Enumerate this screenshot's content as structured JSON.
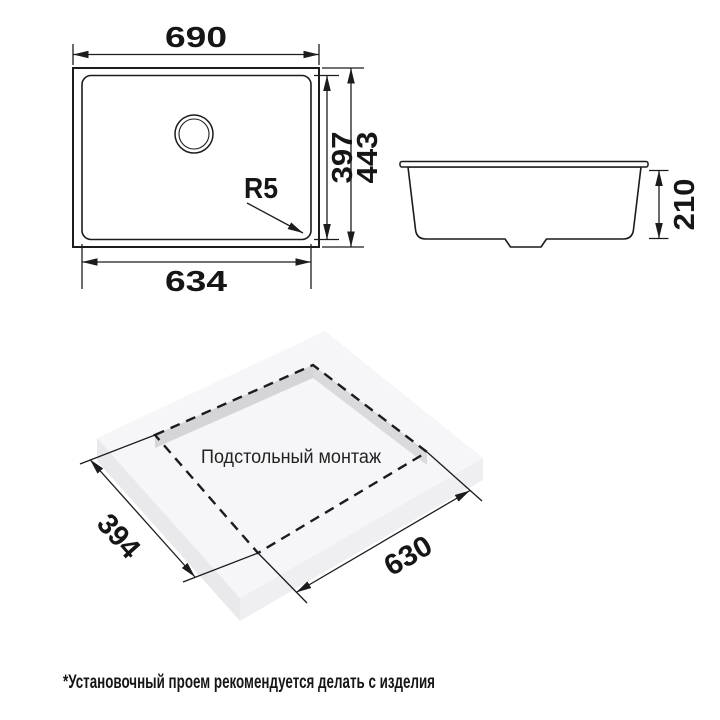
{
  "colors": {
    "line": "#1c1c1e",
    "slab_top": "#f6f6f8",
    "slab_side_sw": "#e9e9ec",
    "slab_side_se": "#efeff1",
    "cutout_wall_nw": "#d5d5d8",
    "cutout_wall_ne": "#dadadc"
  },
  "plan_view": {
    "width_label": "690",
    "inner_width_label": "634",
    "inner_height_label": "397",
    "outer_height_label": "443",
    "corner_radius_label": "R5"
  },
  "side_view": {
    "depth_label": "210"
  },
  "iso_view": {
    "caption": "Подстольный монтаж",
    "depth_label": "394",
    "width_label": "630"
  },
  "footnote": "*Установочный проем рекомендуется делать с изделия"
}
